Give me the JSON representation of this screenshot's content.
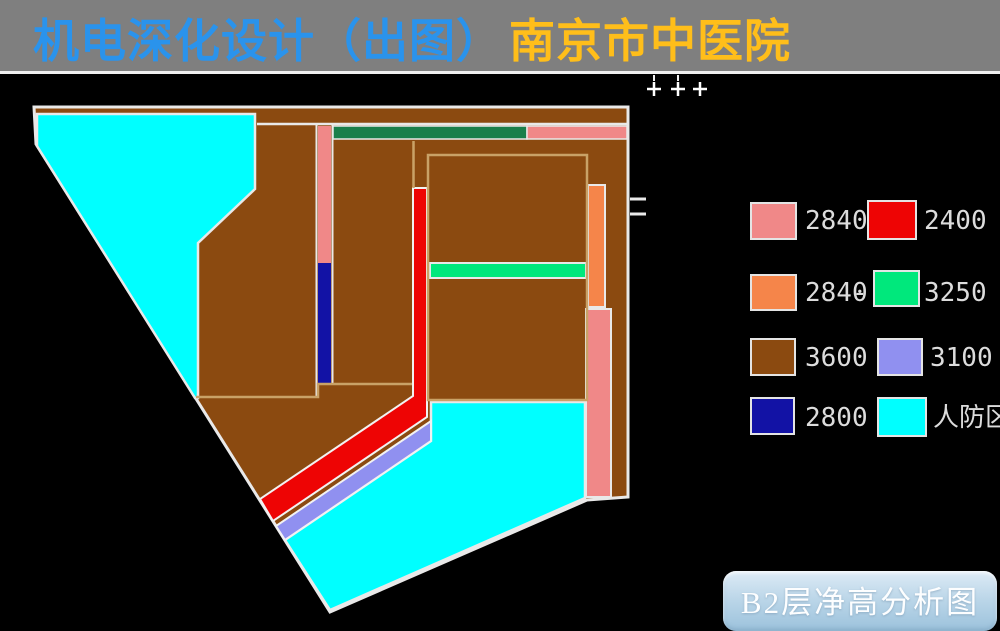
{
  "title": {
    "part1": "机电深化设计（出图）",
    "part2": "南京市中医院"
  },
  "palette": {
    "background": "#000000",
    "titlebar_gray": "#7f7f7f",
    "title_blue": "#2a93ec",
    "title_yellow": "#ffbe1a",
    "brown": "#8b4a10",
    "cyan": "#00ffff",
    "pink": "#f08888",
    "red": "#ee0404",
    "orange": "#f5854a",
    "spring_green": "#00e87c",
    "dark_green": "#1a7f4b",
    "periwinkle": "#9090f0",
    "navy": "#1212a5",
    "outline_white": "#e9e9e9",
    "outline_tan": "#c9a267"
  },
  "legend": {
    "separator": "-",
    "items": [
      {
        "label": "2840",
        "color": "#f08888",
        "color_key": "pink"
      },
      {
        "label": "2400",
        "color": "#ee0404",
        "color_key": "red"
      },
      {
        "label": "2840",
        "color": "#f5854a",
        "color_key": "orange"
      },
      {
        "label": "3250",
        "color": "#00e87c",
        "color_key": "spring_green"
      },
      {
        "label": "3600",
        "color": "#8b4a10",
        "color_key": "brown"
      },
      {
        "label": "3100",
        "color": "#9090f0",
        "color_key": "periwinkle"
      },
      {
        "label": "2800",
        "color": "#1212a5",
        "color_key": "navy"
      },
      {
        "label": "人防区",
        "color": "#00ffff",
        "color_key": "cyan"
      }
    ]
  },
  "caption": {
    "text": "B2层净高分析图"
  },
  "plan": {
    "regions": [
      {
        "area": "upper-left-wedge",
        "category": "人防区",
        "color_key": "cyan"
      },
      {
        "area": "lower-center",
        "category": "人防区",
        "color_key": "cyan"
      },
      {
        "area": "main-floor-field",
        "category": "3600",
        "color_key": "brown"
      },
      {
        "area": "vertical-and-diagonal-corridor",
        "category": "2400",
        "color_key": "red"
      },
      {
        "area": "diagonal-band-below-red",
        "category": "3100",
        "color_key": "periwinkle"
      },
      {
        "area": "top-bar-left",
        "category": null,
        "color_key": "dark_green"
      },
      {
        "area": "top-bar-right",
        "category": "2840",
        "color_key": "pink"
      },
      {
        "area": "left-vertical-strip-upper",
        "category": "2840",
        "color_key": "pink"
      },
      {
        "area": "left-vertical-strip-lower",
        "category": "2800",
        "color_key": "navy"
      },
      {
        "area": "right-vertical-strip-upper",
        "category": "2840",
        "color_key": "orange"
      },
      {
        "area": "right-vertical-strip-lower",
        "category": "2840",
        "color_key": "pink"
      },
      {
        "area": "room-divider-bar",
        "category": "3250",
        "color_key": "spring_green"
      }
    ]
  }
}
